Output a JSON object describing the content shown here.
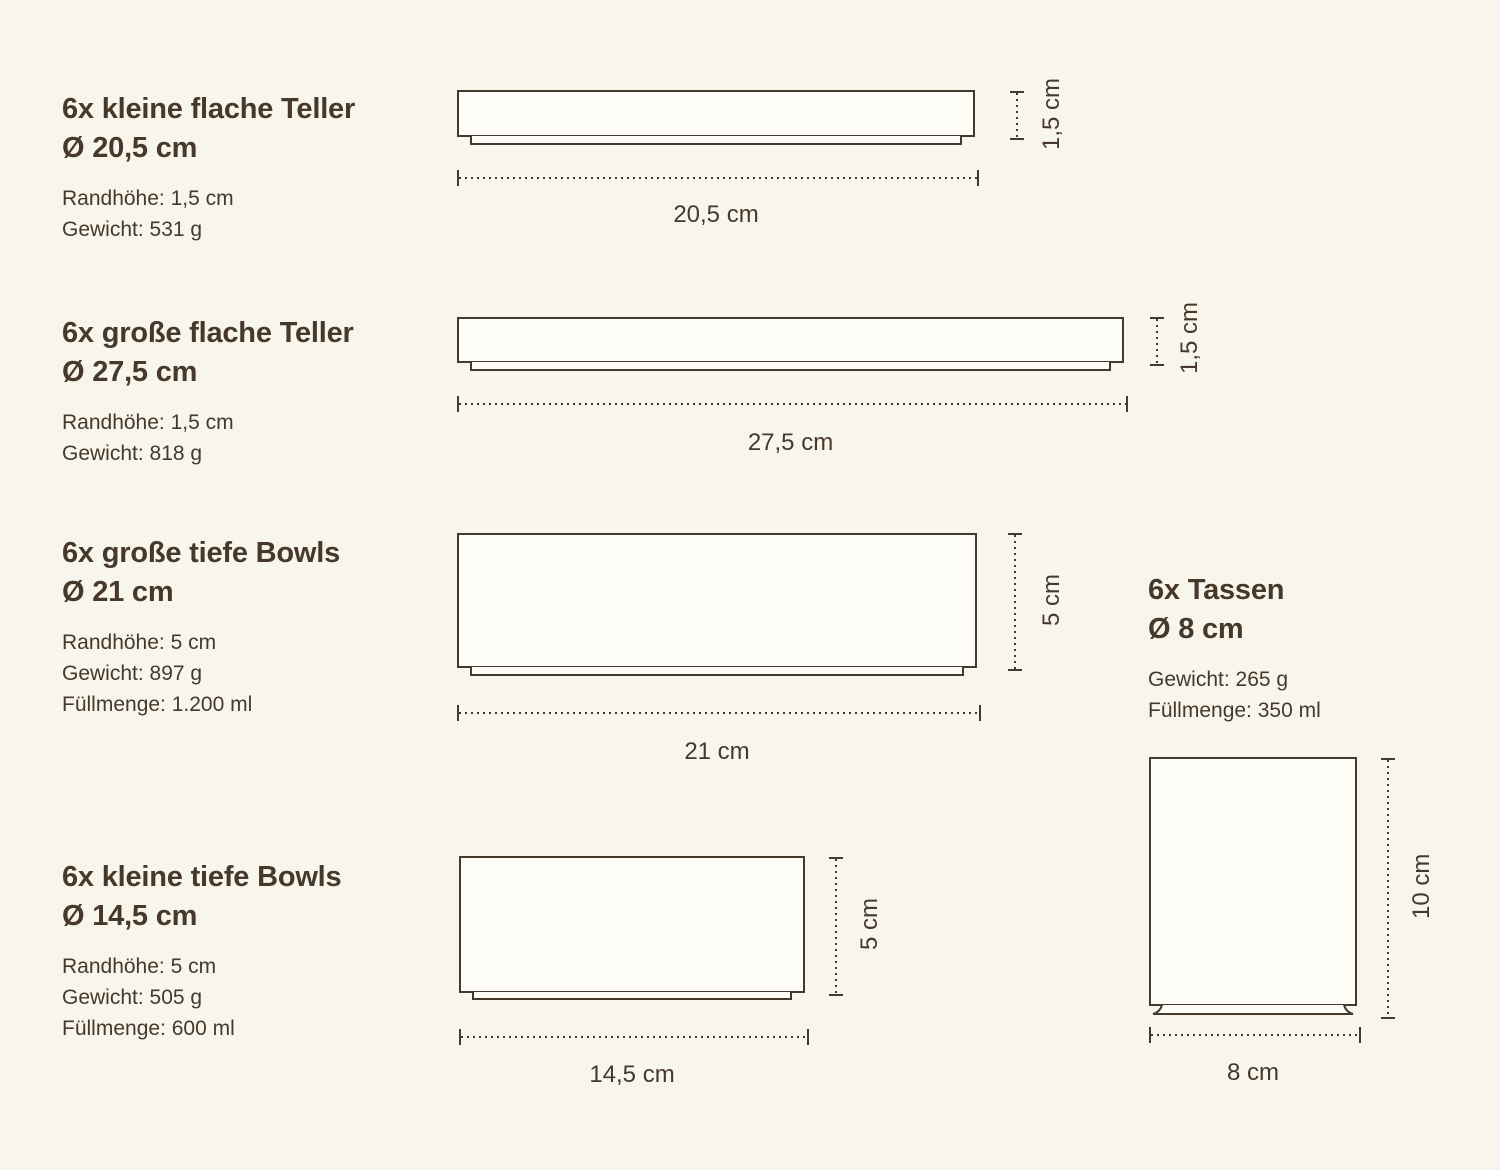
{
  "styles": {
    "background": "#f8f5ed",
    "ink": "#46392a",
    "vessel_fill": "#fdfcf7"
  },
  "products": [
    {
      "title1": "6x kleine flache Teller",
      "title2": "Ø 20,5 cm",
      "specs": [
        "Randhöhe: 1,5 cm",
        "Gewicht: 531 g"
      ],
      "width_label": "20,5 cm",
      "height_label": "1,5 cm"
    },
    {
      "title1": "6x große flache Teller",
      "title2": "Ø 27,5 cm",
      "specs": [
        "Randhöhe: 1,5 cm",
        "Gewicht: 818 g"
      ],
      "width_label": "27,5 cm",
      "height_label": "1,5 cm"
    },
    {
      "title1": "6x große tiefe Bowls",
      "title2": "Ø 21 cm",
      "specs": [
        "Randhöhe: 5 cm",
        "Gewicht: 897 g",
        "Füllmenge: 1.200 ml"
      ],
      "width_label": "21 cm",
      "height_label": "5 cm"
    },
    {
      "title1": "6x Tassen",
      "title2": "Ø 8 cm",
      "specs": [
        "Gewicht: 265 g",
        "Füllmenge: 350 ml"
      ],
      "width_label": "8 cm",
      "height_label": "10 cm"
    },
    {
      "title1": "6x kleine tiefe Bowls",
      "title2": "Ø 14,5 cm",
      "specs": [
        "Randhöhe: 5 cm",
        "Gewicht: 505 g",
        "Füllmenge: 600 ml"
      ],
      "width_label": "14,5 cm",
      "height_label": "5 cm"
    }
  ]
}
